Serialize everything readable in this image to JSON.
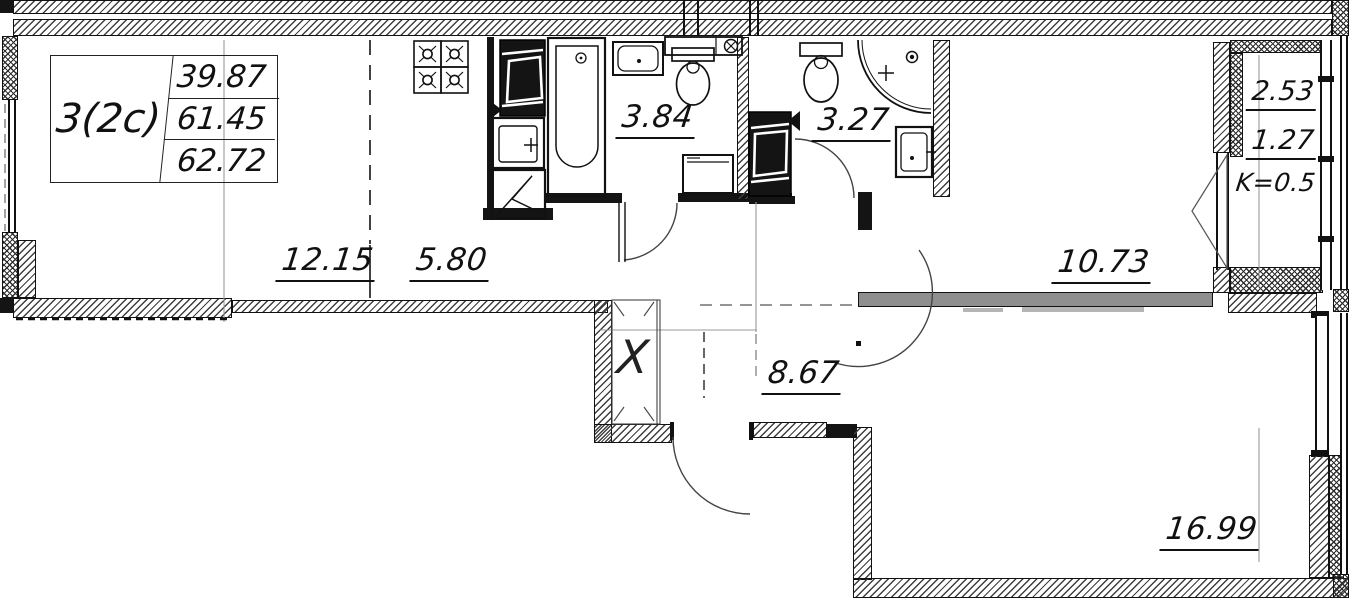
{
  "plan": {
    "title_block": {
      "flat_type": "3(2c)",
      "living_area": "39.87",
      "area_without_summer": "61.45",
      "total_area": "62.72"
    },
    "rooms": {
      "living": {
        "area": "12.15"
      },
      "kitchen": {
        "area": "5.80"
      },
      "bathroom": {
        "area": "3.84"
      },
      "shower_room": {
        "area": "3.27"
      },
      "bedroom": {
        "area": "10.73"
      },
      "hallway": {
        "area": "8.67"
      },
      "bedroom_large": {
        "area": "16.99"
      }
    },
    "balcony": {
      "area_full": "2.53",
      "area_counted": "1.27",
      "coefficient": "K=0.5"
    },
    "wardrobe": {
      "symbol": "X"
    },
    "colors": {
      "wall_line": "#141414",
      "hatch": "#3f3f3f",
      "gray_wall": "#8f8f8f",
      "reference_line": "#999999"
    }
  }
}
